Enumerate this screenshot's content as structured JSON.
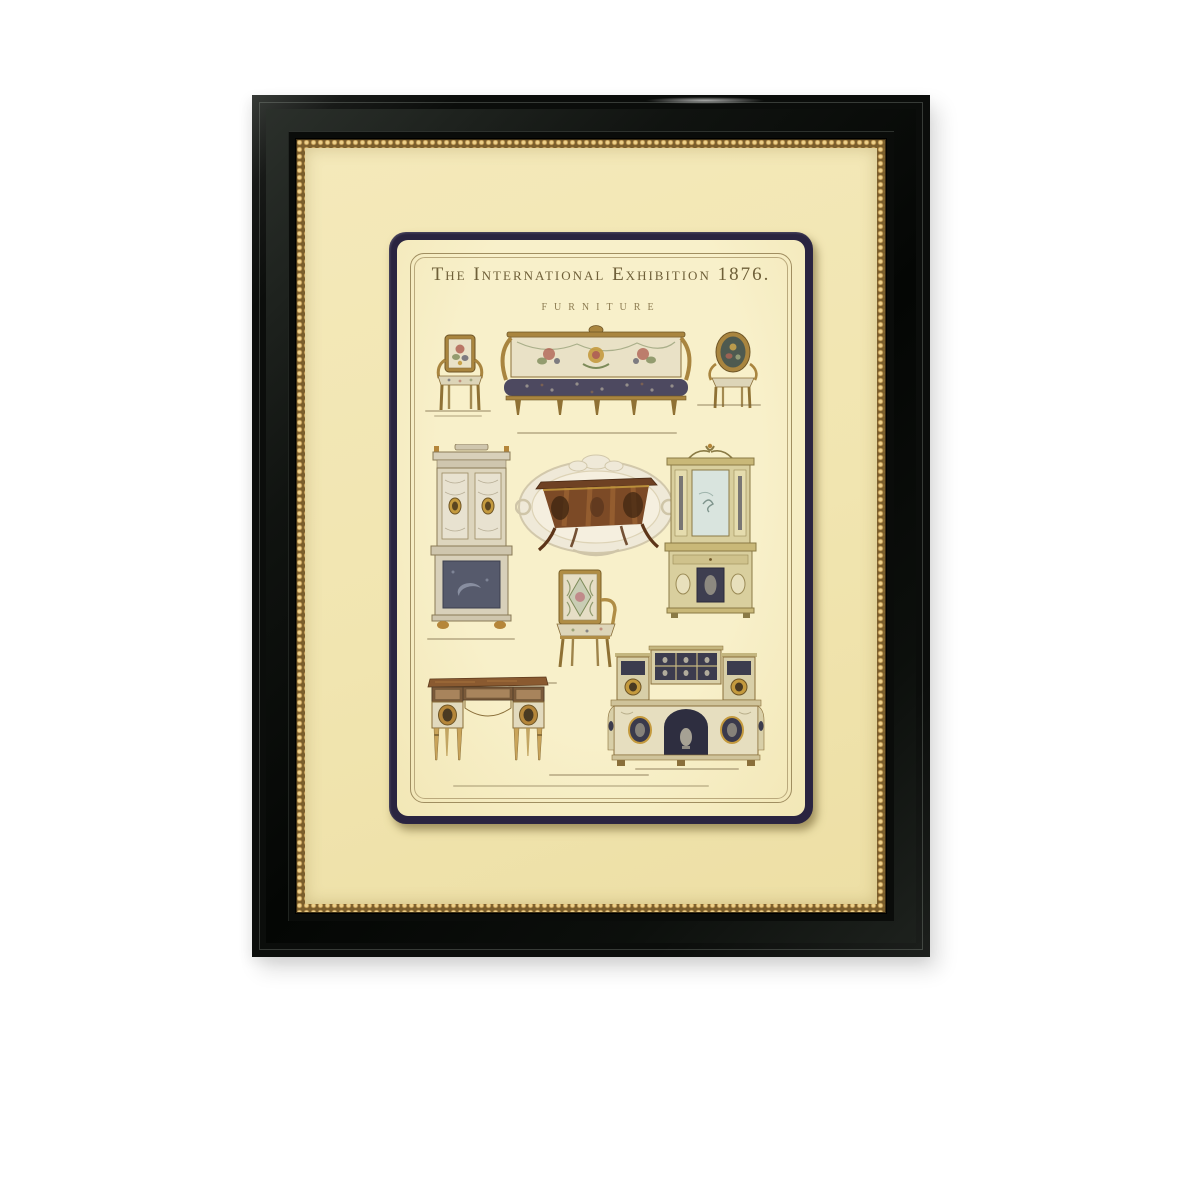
{
  "artwork": {
    "title": "The International Exhibition 1876.",
    "subtitle": "FURNITURE",
    "illustrations": [
      "tapestry-armchair-square-back",
      "tapestry-settee",
      "oval-back-armchair",
      "ivory-marquetry-cabinet",
      "rococo-cartouche-with-commode",
      "mirrored-display-cabinet",
      "tapestry-armchair-gilt-frame",
      "inlaid-writing-desk",
      "carved-sideboard-with-niche"
    ],
    "frame": {
      "frame_color": "#0b0d0b",
      "gold_bead_color": "#b28a46",
      "mat_color": "#f2e6b2",
      "print_border_color": "#2a2440",
      "paper_color": "#f6eec6",
      "rule_line_color": "#a08e60"
    }
  }
}
